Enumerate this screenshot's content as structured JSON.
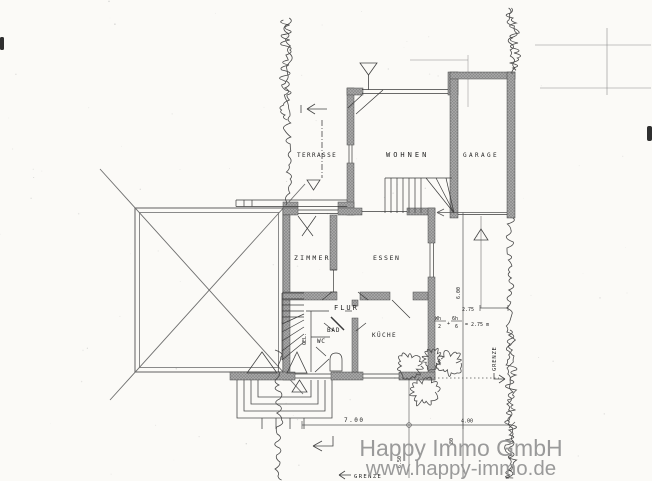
{
  "watermark": {
    "line1": "Happy Immo GmbH",
    "line2": "www.happy-immo.de"
  },
  "rooms": {
    "terrasse": "TERRASSE",
    "wohnen": "WOHNEN",
    "garage": "GARAGE",
    "zimmer": "ZIMMER",
    "essen": "ESSEN",
    "flur": "FLUR",
    "bad": "BAD",
    "wc": "WC",
    "kueche": "KÜCHE",
    "gel": "GEL."
  },
  "boundary": {
    "right": "GRENZE",
    "bottom": "GRENZE"
  },
  "dimensions": {
    "house_width": "7.00",
    "right_width": "4.00",
    "right_depth": "6.00",
    "setback": "2.75",
    "left_depth": "6.50",
    "small": "80",
    "formula": {
      "num1": "Wh",
      "den1": "2",
      "plus": "+",
      "num2": "6h",
      "den2": "6",
      "result": "= 2.75 m"
    }
  }
}
